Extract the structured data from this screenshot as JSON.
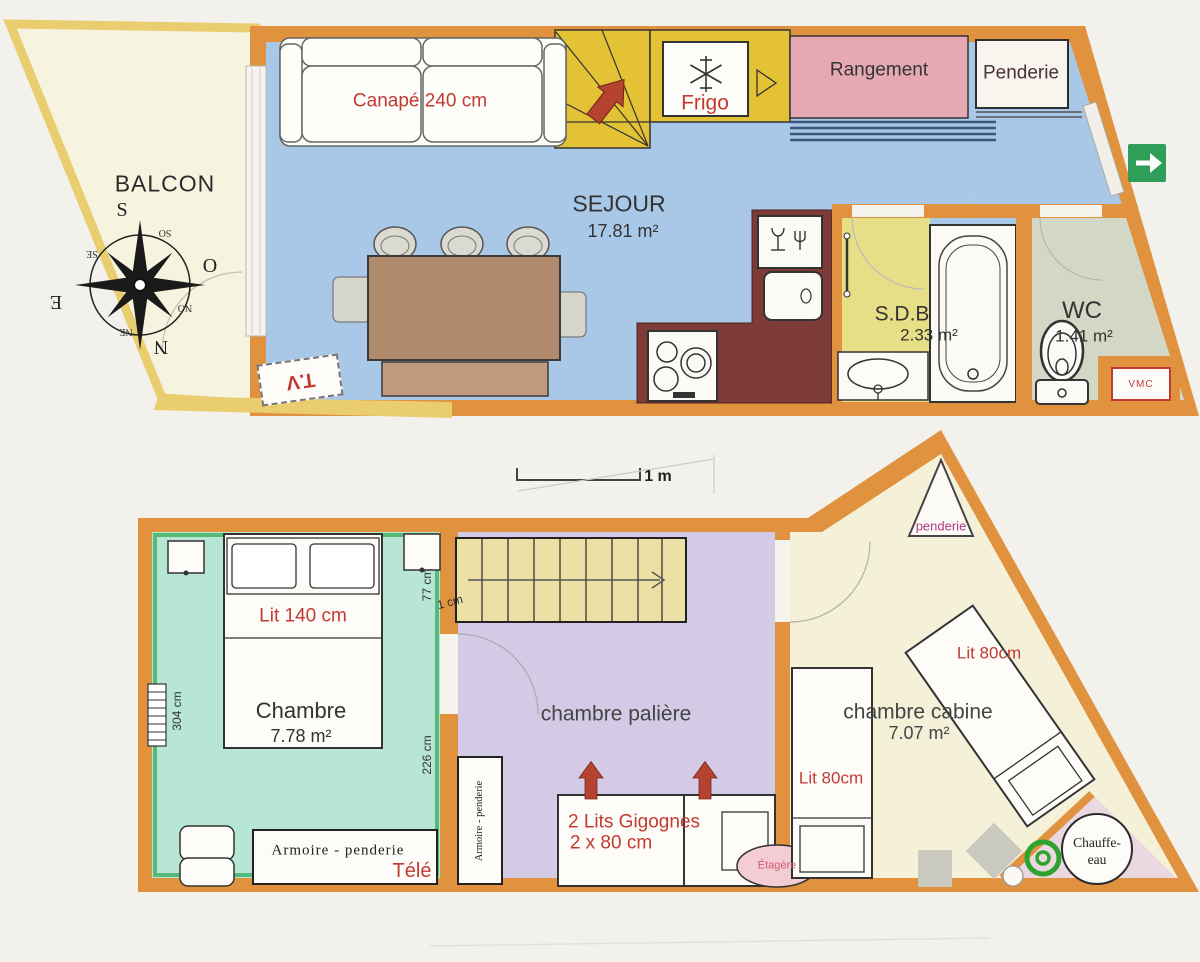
{
  "upper": {
    "balcony": "BALCON",
    "sofa": "Canapé 240 cm",
    "room": "SEJOUR",
    "room_area": "17.81 m²",
    "fridge": "Frigo",
    "storage": "Rangement",
    "wardrobe": "Penderie",
    "bath": "S.D.B",
    "bath_area": "2.33 m²",
    "wc": "WC",
    "wc_area": "1.41 m²",
    "vmc": "VMC",
    "tv": "T.V",
    "compass": {
      "s": "S",
      "o": "O",
      "e": "E",
      "n": "N",
      "so": "SO",
      "se": "SE",
      "no": "NO",
      "ne": "NE"
    }
  },
  "scale": {
    "label": "1 m"
  },
  "lower": {
    "bedroom": {
      "bed": "Lit 140 cm",
      "room": "Chambre",
      "area": "7.78 m²",
      "wardrobe": "Armoire - penderie",
      "tv": "Télé",
      "dim_left": "304 cm",
      "dim_right": "226 cm",
      "dim_top": "77 cm",
      "dim_note": "1 cm"
    },
    "landing": {
      "room": "chambre palière",
      "wardrobe": "Armoire - penderie",
      "bed_line1": "2 Lits Gigognes",
      "bed_line2": "2 x 80 cm",
      "shelf": "Étagère"
    },
    "cabin": {
      "room": "chambre cabine",
      "area": "7.07 m²",
      "bed_left": "Lit 80cm",
      "bed_right": "Lit 80cm",
      "wardrobe": "penderie",
      "heater_line1": "Chauffe-",
      "heater_line2": "eau"
    }
  },
  "colors": {
    "wall_orange": "#e0923f",
    "balcony_gold": "#e9cd6e",
    "living_floor_blue": "#a9c7e6",
    "bedroom_floor_mint": "#b7e6d5",
    "landing_floor_lavender": "#d3cbe5",
    "cabin_floor_cream": "#f4f1d8",
    "bath_floor_yellow": "#e6df87",
    "wc_floor_gray": "#d3d7c5",
    "storage_pink": "#e6a9b4",
    "counter_maroon": "#7c3b37",
    "stairs_gold": "#e4c235",
    "exit_green": "#2f9e59",
    "label_red": "#c23b32"
  }
}
